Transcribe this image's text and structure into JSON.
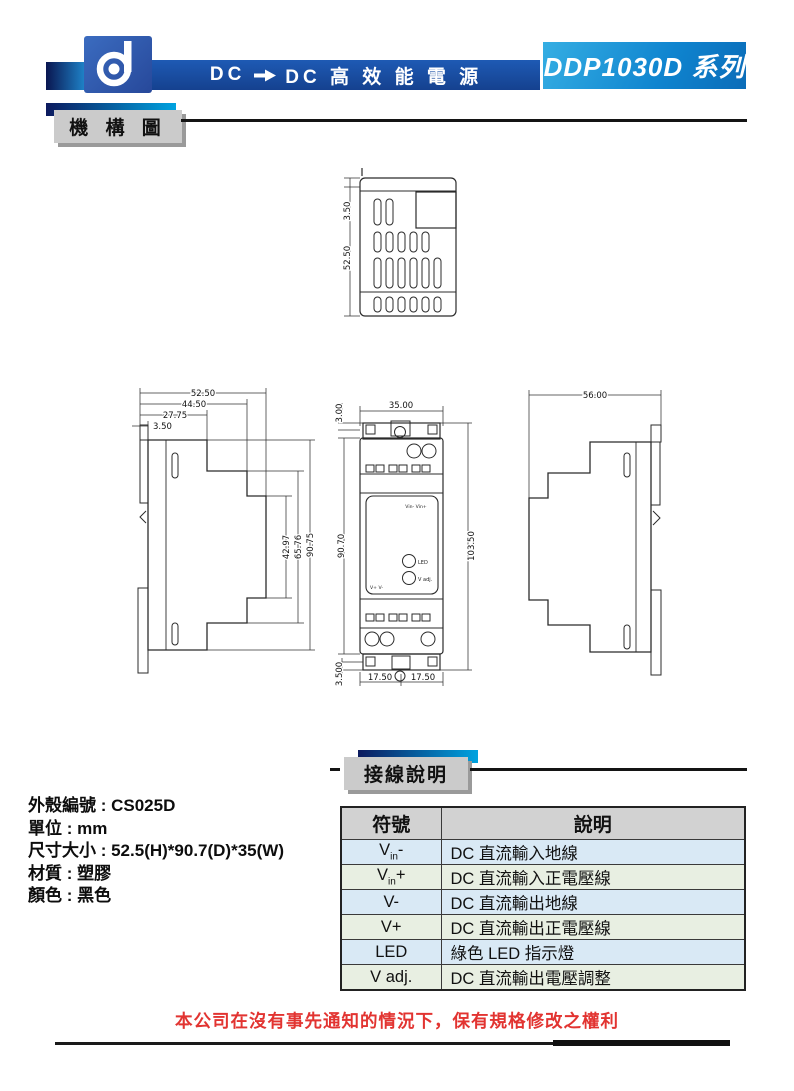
{
  "header": {
    "title_prefix": "DC",
    "title_suffix": "DC  高  效  能  電  源",
    "series": "DDP1030D 系列"
  },
  "section_mechanism": {
    "label": "機 構 圖"
  },
  "section_wiring": {
    "label": "接線說明"
  },
  "drawings": {
    "top_view": {
      "dims": {
        "cap": "3.50",
        "height": "52.50"
      }
    },
    "left_view": {
      "dims": {
        "w_full": "52.50",
        "w_mid": "44.50",
        "w_front": "27.75",
        "w_lip": "3.50",
        "h_mid": "42.97",
        "h_upper": "65.76",
        "h_full": "90.75"
      }
    },
    "front_view": {
      "dims": {
        "top_lip": "3.00",
        "width": "35.00",
        "body_h": "90.70",
        "full_h": "103.50",
        "bottom_lip": "3.500",
        "half_left": "17.50",
        "half_right": "17.50"
      },
      "labels": {
        "vin": "Vin-  Vin+",
        "led": "LED",
        "vadj": "V adj.",
        "vout": "V+   V-"
      }
    },
    "right_view": {
      "dims": {
        "depth": "56.00"
      }
    }
  },
  "specs": {
    "lines": [
      "外殼編號 : CS025D",
      "單位 : mm",
      "尺寸大小 : 52.5(H)*90.7(D)*35(W)",
      "材質 : 塑膠",
      "顏色 : 黑色"
    ]
  },
  "table": {
    "headers": [
      "符號",
      "說明"
    ],
    "rows": [
      {
        "sym_pre": "V",
        "sym_sub": "in",
        "sym_post": "-",
        "desc": "DC 直流輸入地線"
      },
      {
        "sym_pre": "V",
        "sym_sub": "in",
        "sym_post": "+",
        "desc": "DC 直流輸入正電壓線"
      },
      {
        "sym_pre": "V-",
        "sym_sub": "",
        "sym_post": "",
        "desc": "DC 直流輸出地線"
      },
      {
        "sym_pre": "V+",
        "sym_sub": "",
        "sym_post": "",
        "desc": "DC 直流輸出正電壓線"
      },
      {
        "sym_pre": "LED",
        "sym_sub": "",
        "sym_post": "",
        "desc": "綠色 LED 指示燈"
      },
      {
        "sym_pre": "V adj.",
        "sym_sub": "",
        "sym_post": "",
        "desc": "DC 直流輸出電壓調整"
      }
    ]
  },
  "footer": {
    "disclaimer": "本公司在沒有事先通知的情況下，保有規格修改之權利"
  }
}
